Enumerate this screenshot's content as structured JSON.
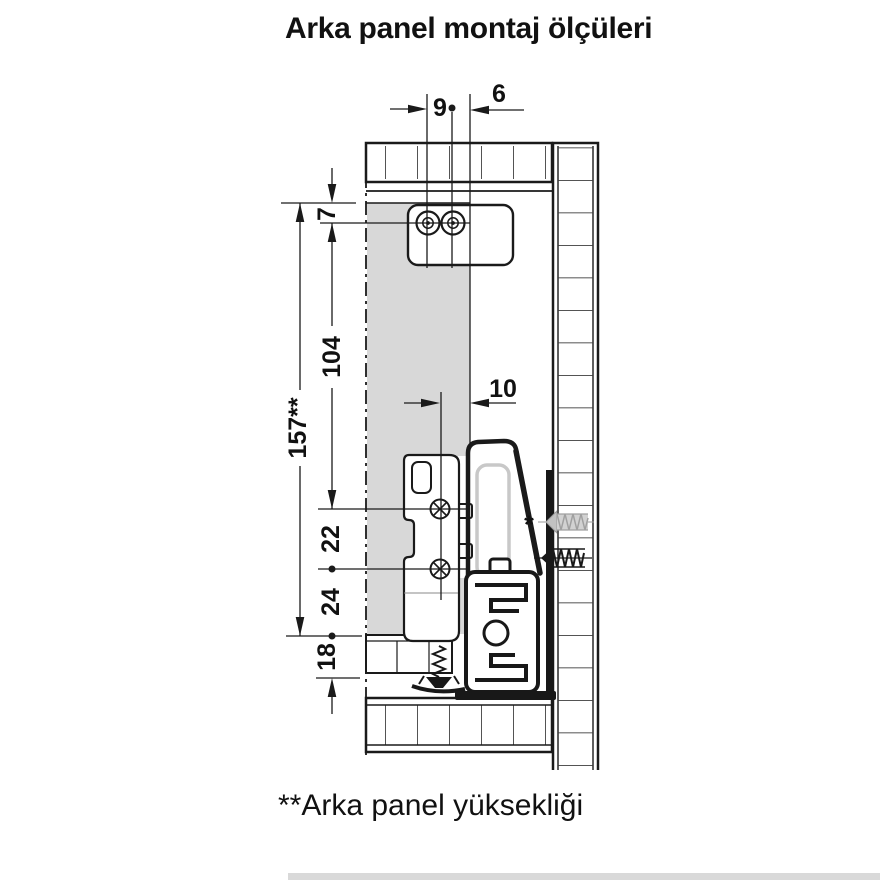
{
  "title": "Arka panel montaj ölçüleri",
  "footnote": "**Arka panel yüksekliği",
  "dims": {
    "d9": "9",
    "d6": "6",
    "d7": "7",
    "d104": "104",
    "d157": "157**",
    "d10": "10",
    "d22": "22",
    "d24": "24",
    "d18": "18"
  },
  "labels": {
    "asterisk_marker": "*"
  },
  "colors": {
    "line": "#1a1a1a",
    "panel-gray": "#d8d8d8",
    "screw-gray": "#c2c2c2",
    "scrollbar": "#d9d9d9"
  }
}
